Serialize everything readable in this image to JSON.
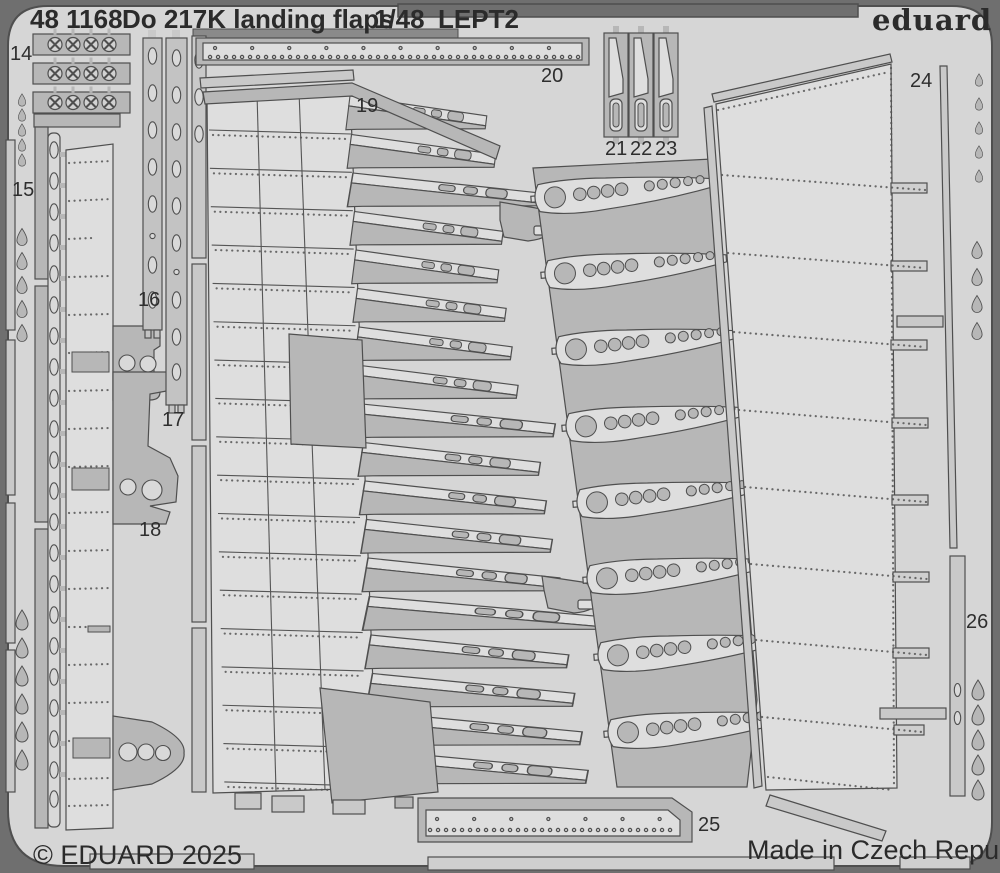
{
  "header": {
    "catalog": "48 1168",
    "title": "Do 217K  landing flaps",
    "scale": "1/48",
    "sheet": "LEPT2"
  },
  "brand": {
    "logo": "eduard"
  },
  "footer": {
    "copyright": "© EDUARD 2025",
    "made_in": "Made in Czech Republic"
  },
  "part_labels": [
    {
      "label": "14"
    },
    {
      "label": "15"
    },
    {
      "label": "16"
    },
    {
      "label": "17"
    },
    {
      "label": "18"
    },
    {
      "label": "19"
    },
    {
      "label": "20"
    },
    {
      "label": "21"
    },
    {
      "label": "22"
    },
    {
      "label": "23"
    },
    {
      "label": "24"
    },
    {
      "label": "25"
    },
    {
      "label": "26"
    }
  ],
  "colors": {
    "background": "#6f6f6f",
    "fret_plate": "#d6d6d6",
    "part_light": "#dedede",
    "part_mid": "#c9c9c9",
    "part_dark": "#b7b7b7",
    "outline": "#4f4f4f",
    "text": "#2b2b2b"
  }
}
